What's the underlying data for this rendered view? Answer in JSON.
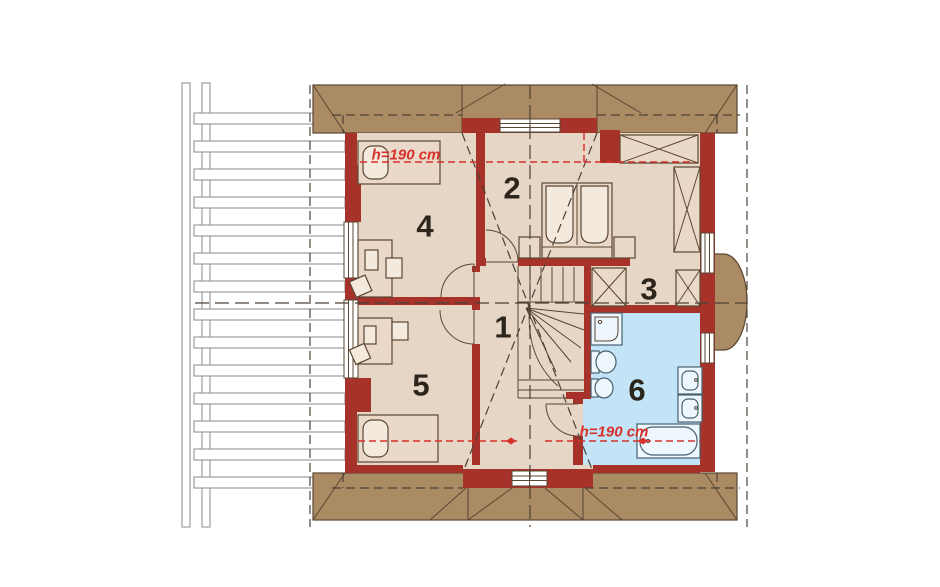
{
  "drawing": {
    "type": "attic floor plan",
    "rooms": [
      {
        "number": "1"
      },
      {
        "number": "2"
      },
      {
        "number": "3"
      },
      {
        "number": "4"
      },
      {
        "number": "5"
      },
      {
        "number": "6"
      }
    ],
    "annotations": {
      "height_label_top": "h=190 cm",
      "height_label_bathroom": "h=190 cm"
    },
    "colors": {
      "wall": "#a7322a",
      "roof": "#ab8b64",
      "floor": "#e5d6c6",
      "bathroom_floor": "#c2e4f6",
      "annotation": "#d6312b",
      "background": "#ffffff"
    }
  }
}
